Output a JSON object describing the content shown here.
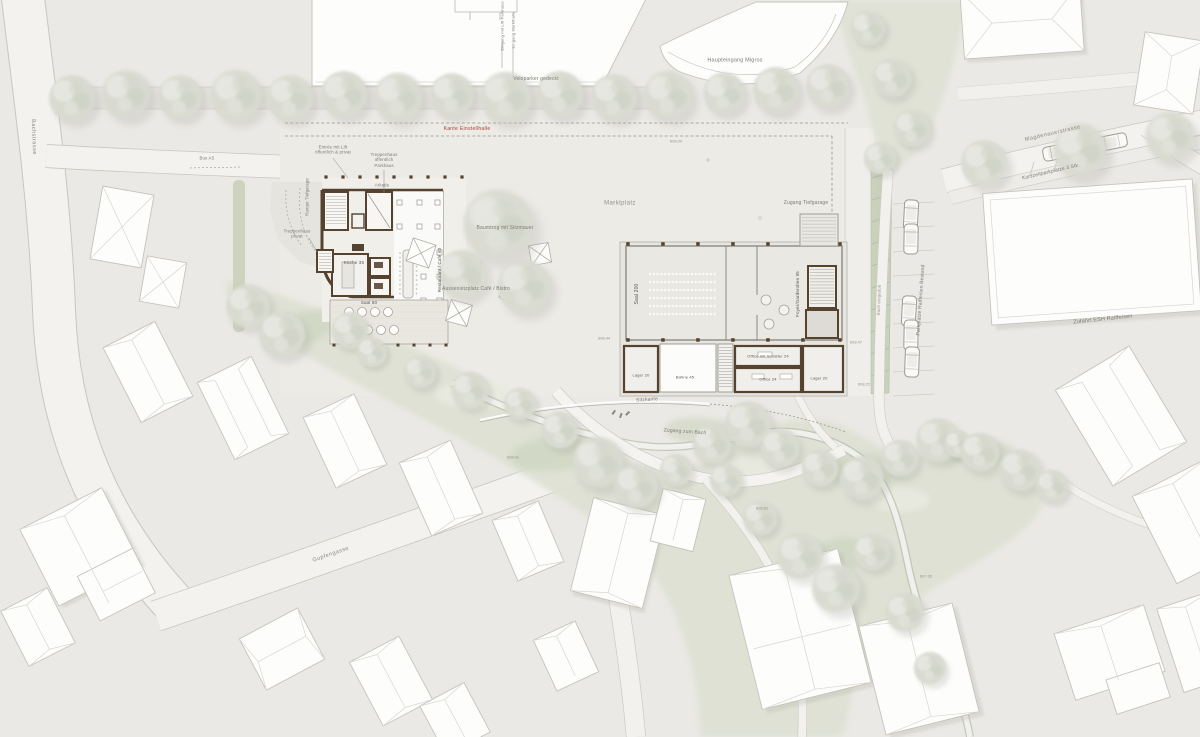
{
  "plan": {
    "streets": {
      "bachstrasse": "Bachstrasse",
      "gupfengasse": "Gupfengasse",
      "magdenauerstrasse": "Magdenauerstrasse"
    },
    "annotations": {
      "bus": "Bus AS",
      "veloparker": "Veloparker gedeckt",
      "eingang_lift": "Eingang mit Lift Parkhaus",
      "eingang_markthalle": "Eingang Markthalle",
      "haupteingang_migros": "Haupteingang Migros",
      "kante_einstellhalle": "Kante Einstellhalle",
      "kurzzeitparkplaetze": "Kurzzeitparkplätze 3 Stk.",
      "zufahrt_esh": "Zufahrt ESH Raiffeisen",
      "parkplaetze_raiffeisen": "Parkplätze Raiffeisen Bestand",
      "bach_eingedolt": "Bach eingedolt",
      "marktplatz": "Marktplatz",
      "zugang_tiefgarage": "Zugang Tiefgarage",
      "entree_lift": "Entrée mit Lift\nöffentlich & privat",
      "treppenhaus_parkhaus": "Treppenhaus\nöffentlich\nParkhaus",
      "treppenhaus_privat": "Treppenhaus\nprivat",
      "rampe_tiefgarage": "Rampe Tiefgarage",
      "arkade": "Arkade",
      "aussensitzplatz": "Aussensitzplatz Café / Bistro",
      "baumtrog": "Baumtrog mit Sitzmauer",
      "sitzkante": "Sitzkante",
      "zugang_bach": "Zugang zum Bach"
    },
    "rooms": {
      "kueche": "Küche 35",
      "restaurant": "Restaurant / Café 60",
      "saal60": "Saal 60",
      "saal200": "Saal 200",
      "foyer": "Foyer/Garderoben 95",
      "lager_l": "Lager 20",
      "buehne": "Bühne 45",
      "office_schalter": "Office mit Schalter 24",
      "office": "Office 24",
      "lager_r": "Lager 20"
    },
    "elevations": [
      "609.00",
      "608.47",
      "608.22",
      "608.44",
      "608.41",
      "608.82",
      "607.35"
    ],
    "colors": {
      "paper": "#ebe9e5",
      "wall_brown": "#55422f",
      "green": "#dde1d3",
      "red_note": "#a63c30"
    }
  }
}
